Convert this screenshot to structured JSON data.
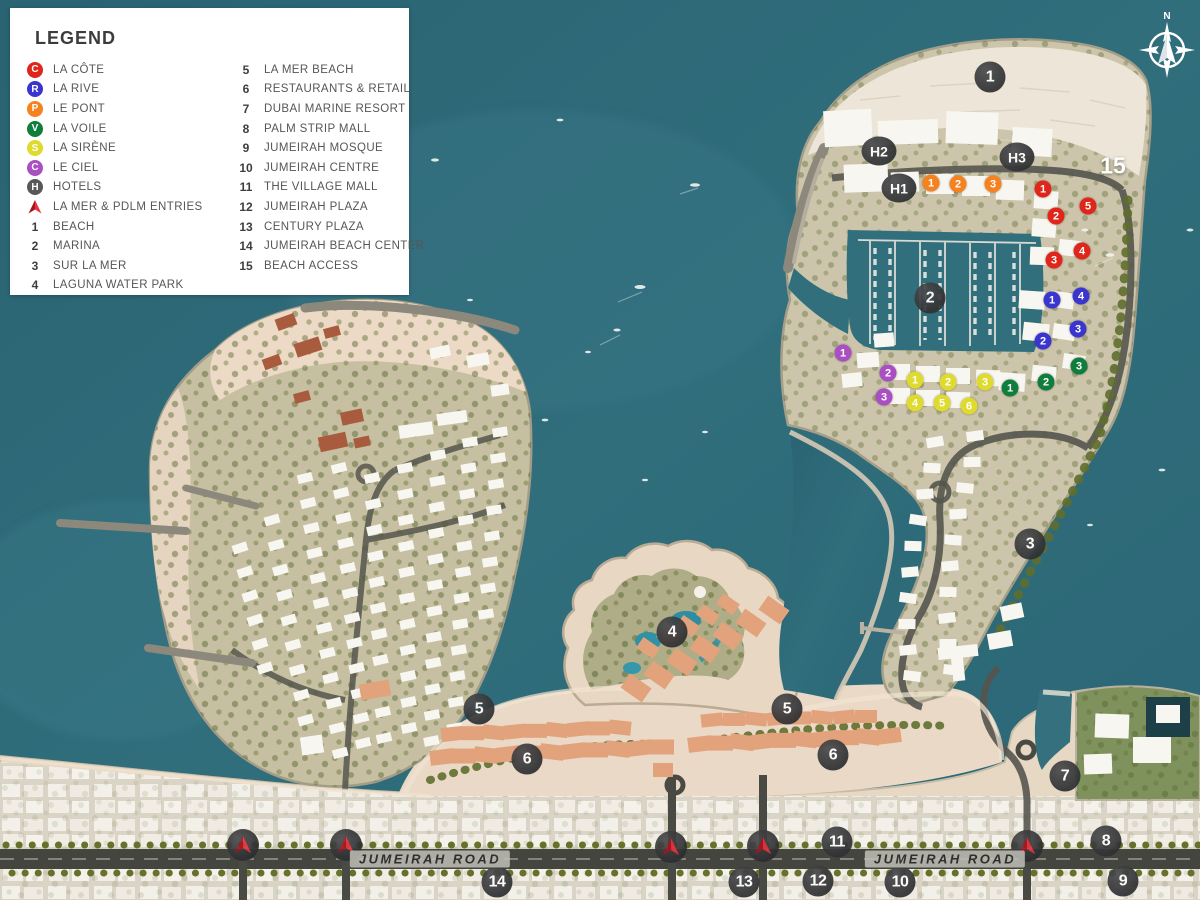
{
  "legend": {
    "title": "LEGEND",
    "districts": [
      {
        "letter": "C",
        "label": "LA CÔTE",
        "color": "#e0251b"
      },
      {
        "letter": "R",
        "label": "LA RIVE",
        "color": "#3a35cf"
      },
      {
        "letter": "P",
        "label": "LE PONT",
        "color": "#f5821f"
      },
      {
        "letter": "V",
        "label": "LA VOILE",
        "color": "#0f7d3c"
      },
      {
        "letter": "S",
        "label": "LA SIRÈNE",
        "color": "#dfda2e"
      },
      {
        "letter": "C",
        "label": "LE CIEL",
        "color": "#a94fc3"
      },
      {
        "letter": "H",
        "label": "HOTELS",
        "color": "#57585a"
      }
    ],
    "entry": {
      "label": "LA MER & PDLM ENTRIES"
    },
    "numbered": [
      {
        "num": "1",
        "label": "BEACH"
      },
      {
        "num": "2",
        "label": "MARINA"
      },
      {
        "num": "3",
        "label": "SUR LA MER"
      },
      {
        "num": "4",
        "label": "LAGUNA WATER PARK"
      },
      {
        "num": "5",
        "label": "LA MER BEACH"
      },
      {
        "num": "6",
        "label": "RESTAURANTS & RETAIL"
      },
      {
        "num": "7",
        "label": "DUBAI MARINE RESORT"
      },
      {
        "num": "8",
        "label": "PALM STRIP MALL"
      },
      {
        "num": "9",
        "label": "JUMEIRAH MOSQUE"
      },
      {
        "num": "10",
        "label": "JUMEIRAH CENTRE"
      },
      {
        "num": "11",
        "label": "THE VILLAGE MALL"
      },
      {
        "num": "12",
        "label": "JUMEIRAH PLAZA"
      },
      {
        "num": "13",
        "label": "CENTURY PLAZA"
      },
      {
        "num": "14",
        "label": "JUMEIRAH BEACH CENTER"
      },
      {
        "num": "15",
        "label": "BEACH ACCESS"
      }
    ]
  },
  "map": {
    "location_markers": [
      {
        "num": "1",
        "x": 990,
        "y": 77
      },
      {
        "num": "2",
        "x": 930,
        "y": 298
      },
      {
        "num": "3",
        "x": 1030,
        "y": 544
      },
      {
        "num": "4",
        "x": 672,
        "y": 632
      },
      {
        "num": "5",
        "x": 479,
        "y": 709
      },
      {
        "num": "5",
        "x": 787,
        "y": 709
      },
      {
        "num": "6",
        "x": 527,
        "y": 759
      },
      {
        "num": "6",
        "x": 833,
        "y": 755
      },
      {
        "num": "7",
        "x": 1065,
        "y": 776
      },
      {
        "num": "8",
        "x": 1106,
        "y": 841
      },
      {
        "num": "9",
        "x": 1123,
        "y": 881
      },
      {
        "num": "10",
        "x": 900,
        "y": 882
      },
      {
        "num": "11",
        "x": 837,
        "y": 842
      },
      {
        "num": "12",
        "x": 818,
        "y": 881
      },
      {
        "num": "13",
        "x": 744,
        "y": 882
      },
      {
        "num": "14",
        "x": 497,
        "y": 882
      }
    ],
    "beach_access_label": {
      "text": "15",
      "x": 1113,
      "y": 166
    },
    "hotel_markers": [
      {
        "label": "H1",
        "x": 899,
        "y": 188
      },
      {
        "label": "H2",
        "x": 879,
        "y": 151
      },
      {
        "label": "H3",
        "x": 1017,
        "y": 157
      }
    ],
    "district_markers": [
      {
        "district": "lacote",
        "color": "#e0251b",
        "points": [
          {
            "num": "1",
            "x": 1043,
            "y": 189
          },
          {
            "num": "2",
            "x": 1056,
            "y": 216
          },
          {
            "num": "3",
            "x": 1054,
            "y": 260
          },
          {
            "num": "4",
            "x": 1082,
            "y": 251
          },
          {
            "num": "5",
            "x": 1088,
            "y": 206
          }
        ]
      },
      {
        "district": "larive",
        "color": "#3a35cf",
        "points": [
          {
            "num": "1",
            "x": 1052,
            "y": 300
          },
          {
            "num": "2",
            "x": 1043,
            "y": 341
          },
          {
            "num": "3",
            "x": 1078,
            "y": 329
          },
          {
            "num": "4",
            "x": 1081,
            "y": 296
          }
        ]
      },
      {
        "district": "lepont",
        "color": "#f5821f",
        "points": [
          {
            "num": "1",
            "x": 931,
            "y": 183
          },
          {
            "num": "2",
            "x": 958,
            "y": 184
          },
          {
            "num": "3",
            "x": 993,
            "y": 184
          }
        ]
      },
      {
        "district": "lavoile",
        "color": "#0f7d3c",
        "points": [
          {
            "num": "1",
            "x": 1010,
            "y": 388
          },
          {
            "num": "2",
            "x": 1046,
            "y": 382
          },
          {
            "num": "3",
            "x": 1079,
            "y": 366
          }
        ]
      },
      {
        "district": "lasirene",
        "color": "#dfda2e",
        "points": [
          {
            "num": "1",
            "x": 915,
            "y": 380
          },
          {
            "num": "2",
            "x": 948,
            "y": 382
          },
          {
            "num": "3",
            "x": 985,
            "y": 382
          },
          {
            "num": "4",
            "x": 915,
            "y": 403
          },
          {
            "num": "5",
            "x": 942,
            "y": 403
          },
          {
            "num": "6",
            "x": 969,
            "y": 406
          }
        ]
      },
      {
        "district": "leciel",
        "color": "#a94fc3",
        "points": [
          {
            "num": "1",
            "x": 843,
            "y": 353
          },
          {
            "num": "2",
            "x": 888,
            "y": 373
          },
          {
            "num": "3",
            "x": 884,
            "y": 397
          }
        ]
      }
    ],
    "entry_markers": [
      {
        "x": 243,
        "y": 845
      },
      {
        "x": 346,
        "y": 845
      },
      {
        "x": 671,
        "y": 847
      },
      {
        "x": 763,
        "y": 846
      },
      {
        "x": 1027,
        "y": 846
      }
    ],
    "road_labels": [
      {
        "text": "JUMEIRAH ROAD",
        "x": 430,
        "y": 859
      },
      {
        "text": "JUMEIRAH ROAD",
        "x": 945,
        "y": 859
      }
    ],
    "compass_letter": "N"
  },
  "colors": {
    "ocean": "#2e6b78",
    "sand": "#e9d8c4",
    "beach_white": "#ede5d7",
    "road": "#45453f",
    "marker_dark": "#323335",
    "entry_red": "#e8323c"
  }
}
